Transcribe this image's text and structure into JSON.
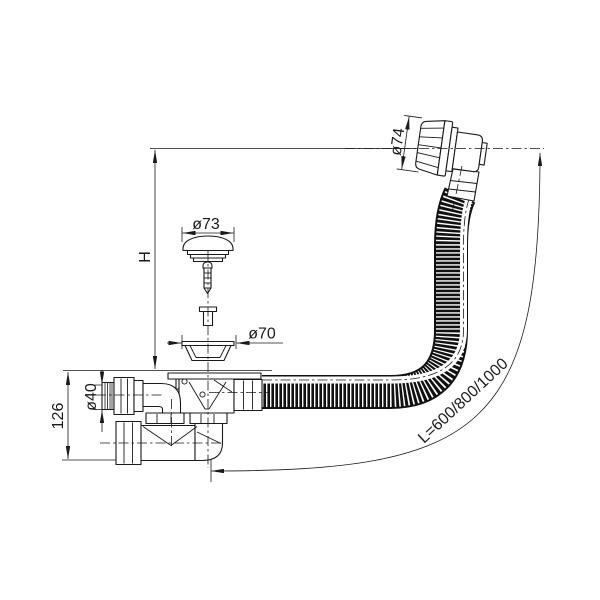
{
  "drawing": {
    "type": "technical-line-drawing",
    "subject_label": "bath waste overflow drain set",
    "colors": {
      "line": "#1a1a1a",
      "background": "#ffffff"
    },
    "dimensions": {
      "mounting_height": "H",
      "plug_diameter": "ø73",
      "flange_diameter": "ø70",
      "overflow_diameter": "ø74",
      "outlet_diameter": "ø40",
      "trap_height": "126",
      "hose_length": "L=600/800/1000"
    }
  }
}
